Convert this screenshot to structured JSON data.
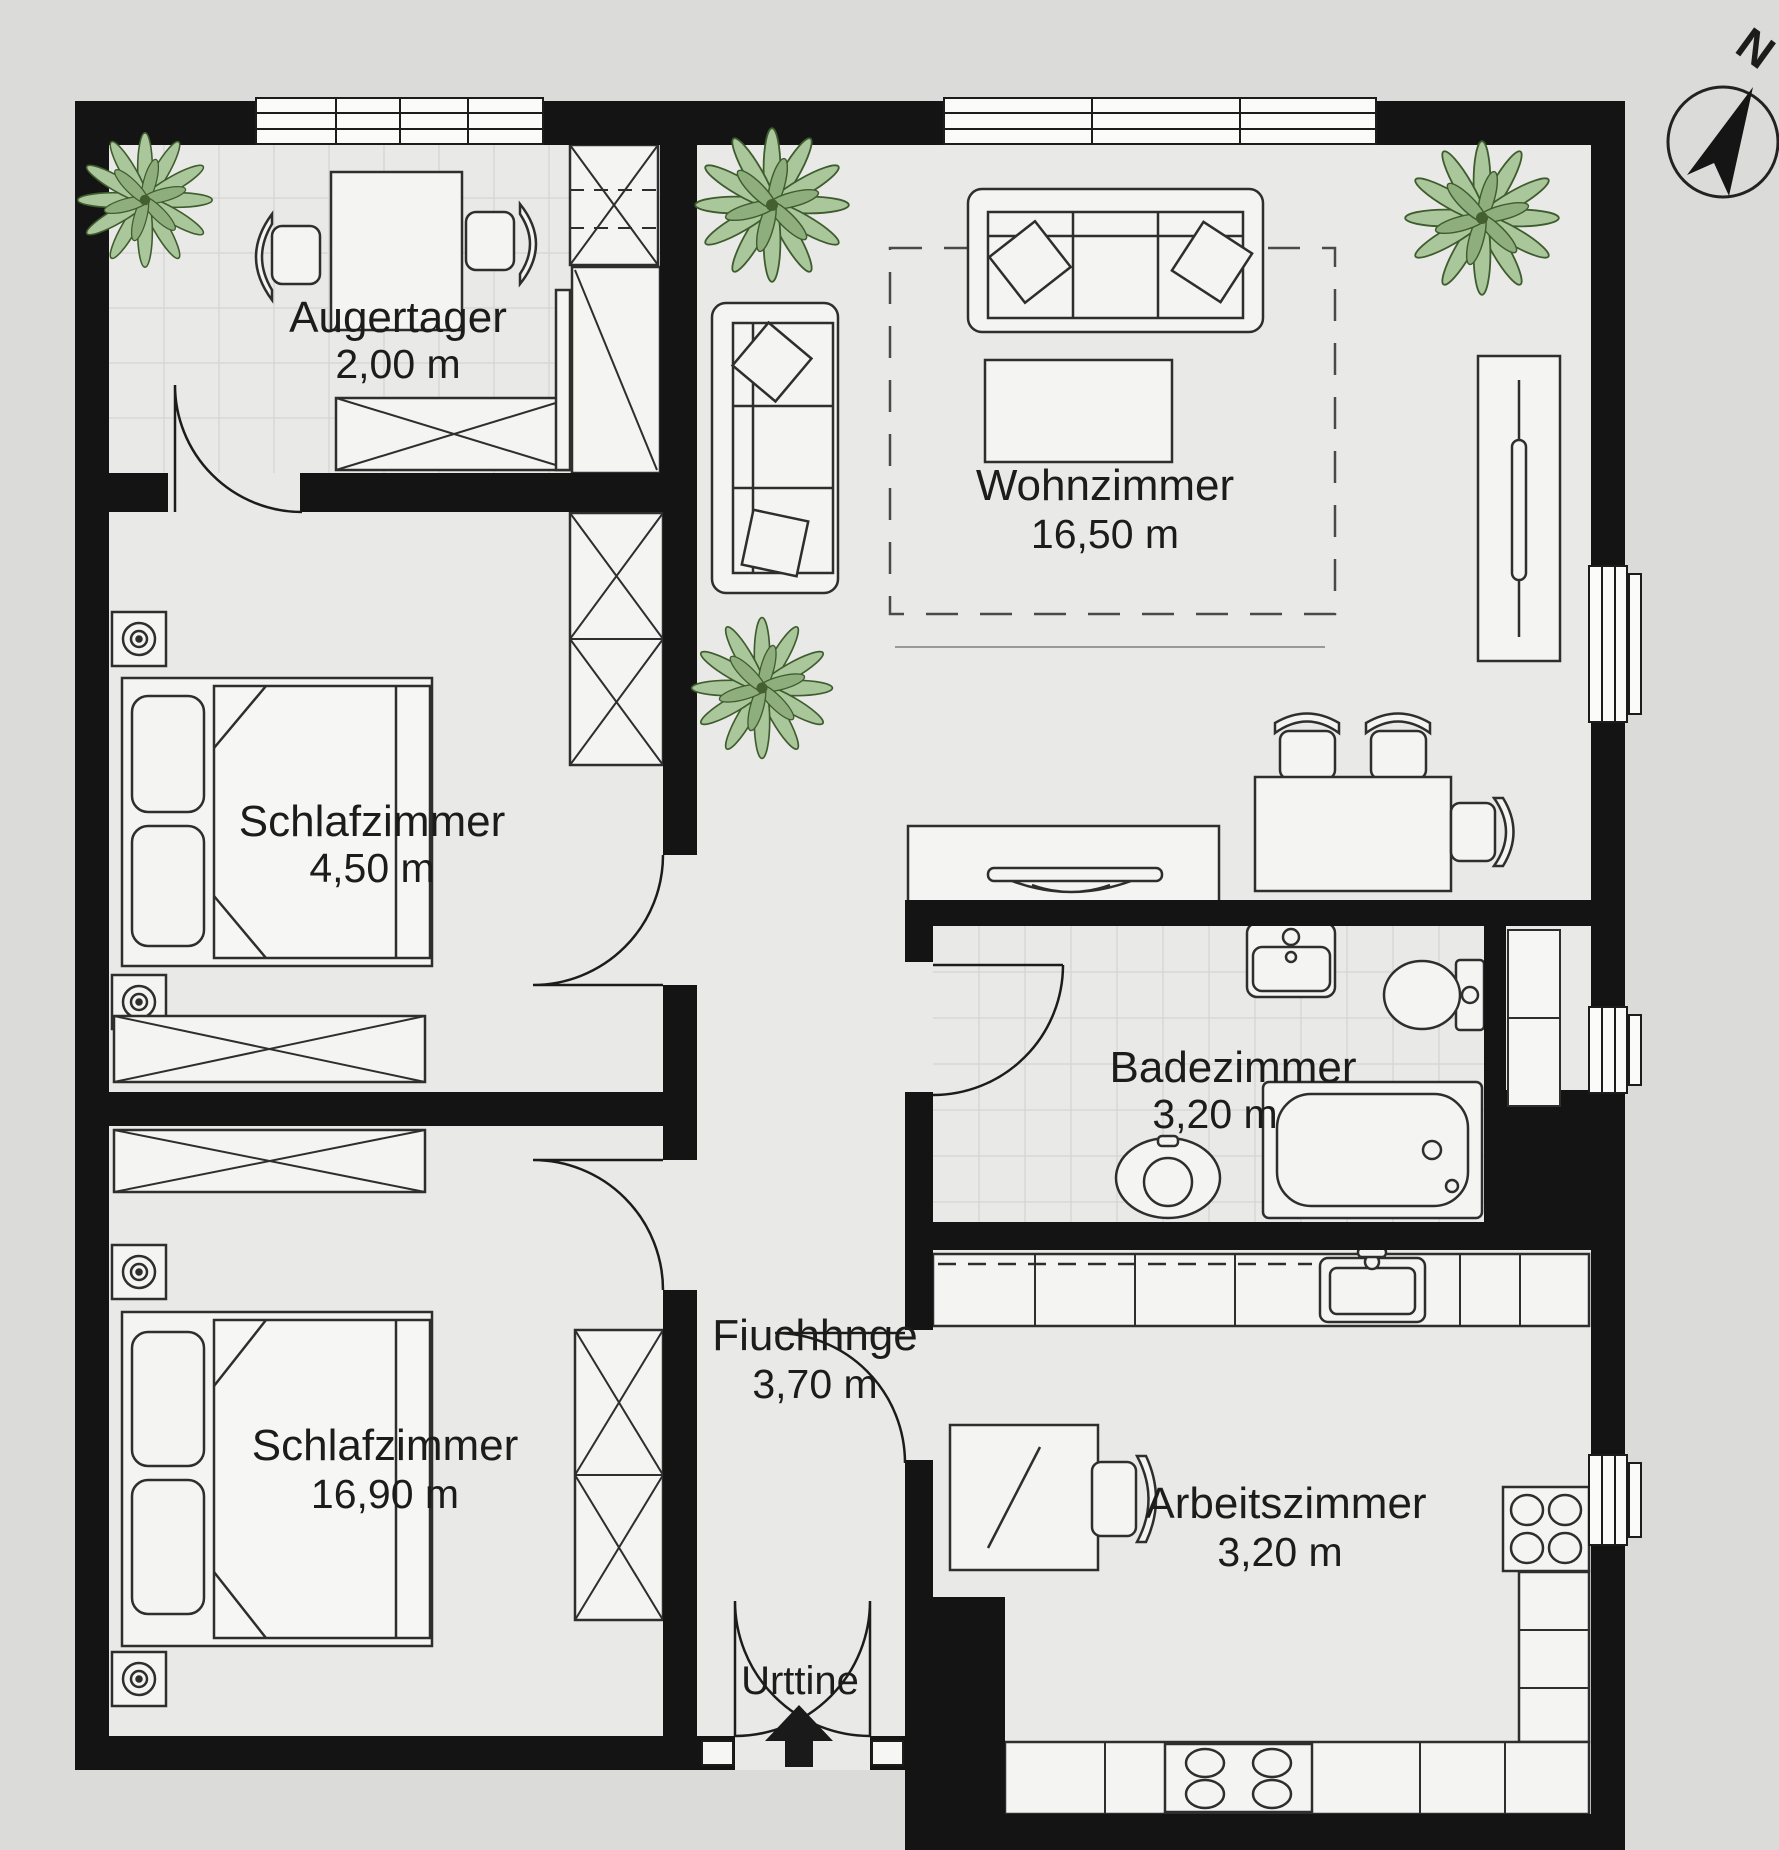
{
  "rooms": [
    {
      "name": "Augertager",
      "area": "2,00 m"
    },
    {
      "name": "Wohnzimmer",
      "area": "16,50 m"
    },
    {
      "name": "Schlafzimmer",
      "area": "4,50 m"
    },
    {
      "name": "Badezimmer",
      "area": "3,20 m"
    },
    {
      "name": "Schlafzimmer",
      "area": "16,90 m"
    },
    {
      "name": "Fiuchhnge",
      "area": "3,70 m"
    },
    {
      "name": "Arbeitszimmer",
      "area": "3,20 m"
    }
  ],
  "entrance": {
    "label": "Urttine"
  },
  "compass": {
    "label": "N"
  },
  "colors": {
    "wall": "#141414",
    "floor": "#e9e9e7",
    "background": "#dbdbd9",
    "tile_line": "#d7d7d5",
    "furniture_fill": "#f4f4f2",
    "outline": "#2e2e2e",
    "plant_leaf": "#a9c79a",
    "plant_dark": "#44602f"
  }
}
